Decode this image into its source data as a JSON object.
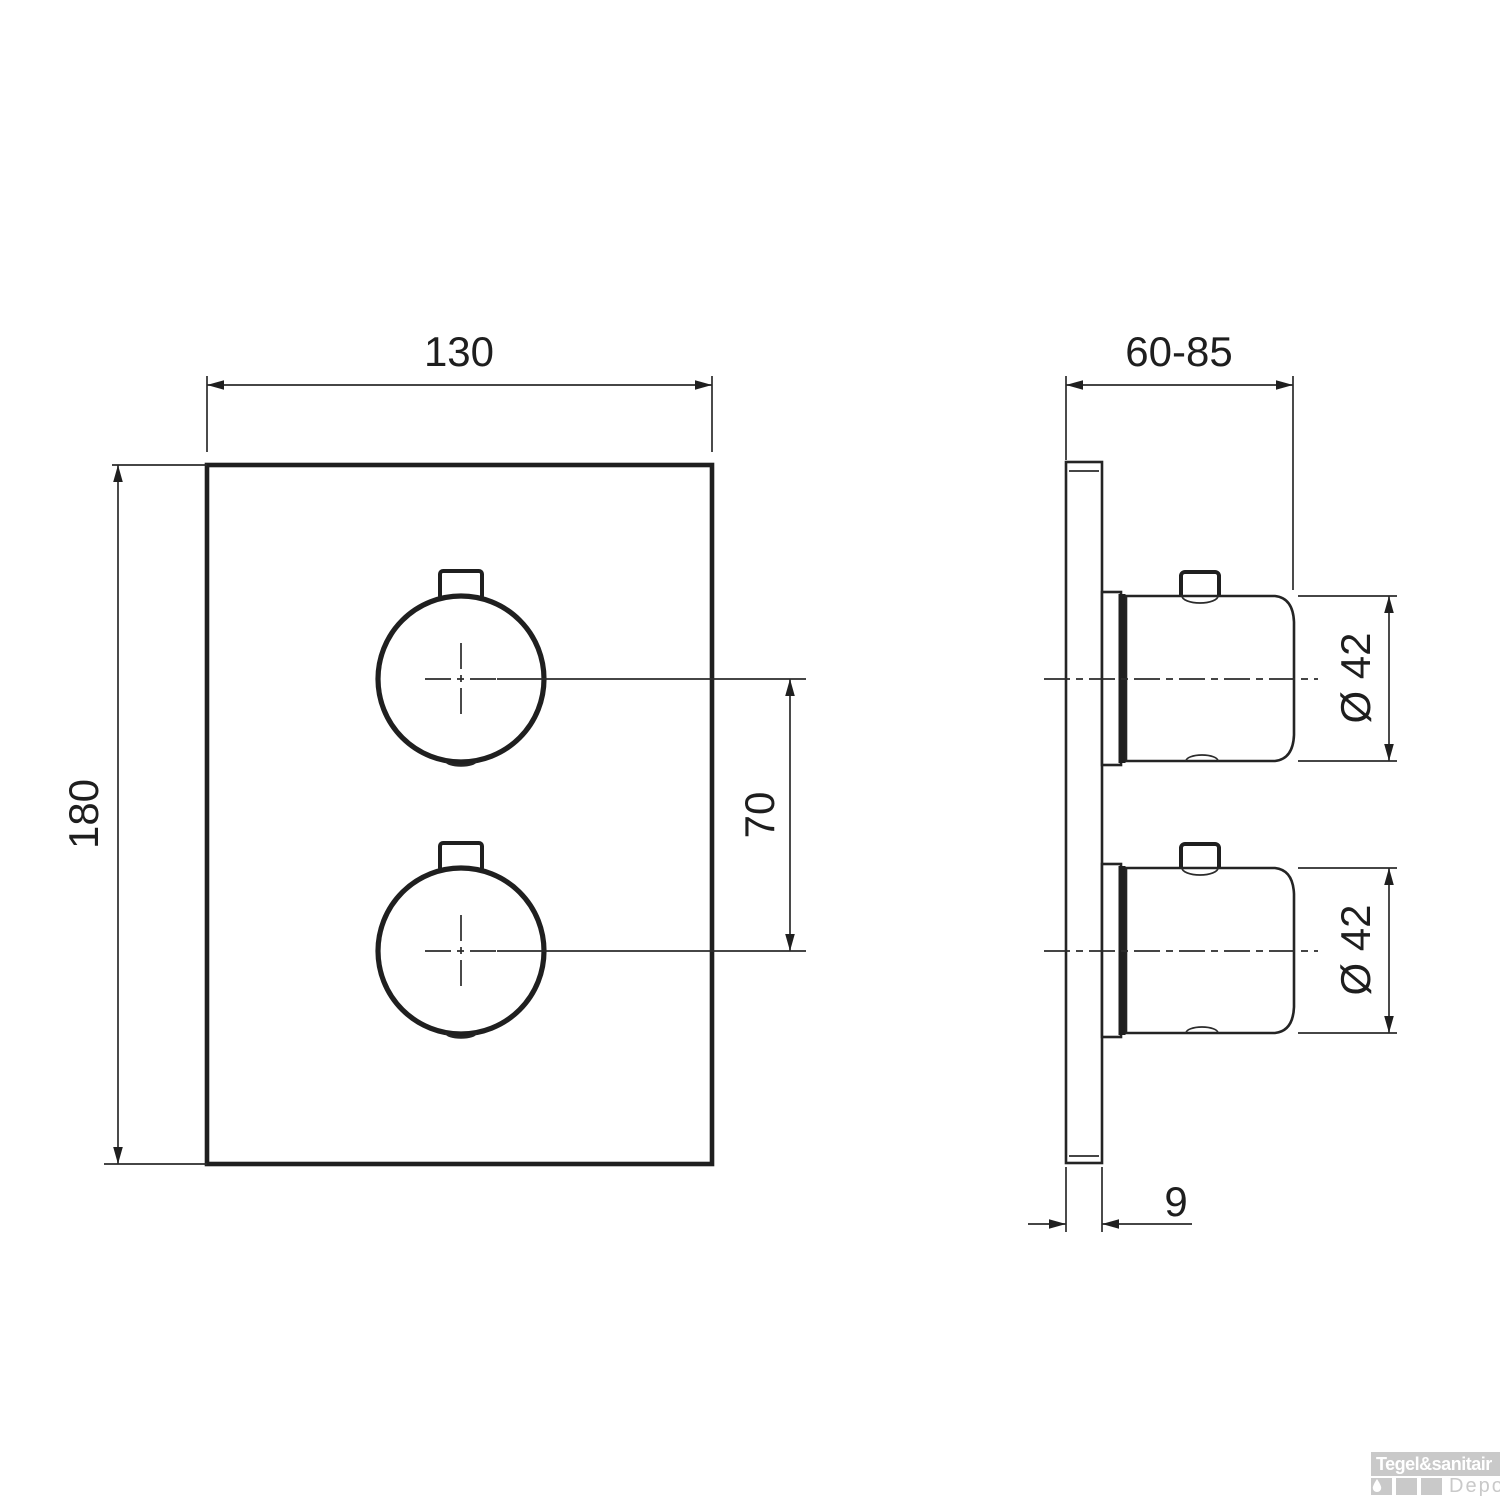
{
  "drawing": {
    "type": "technical-dimension-diagram",
    "front_view": {
      "width": "130",
      "height": "180",
      "handle_spacing": "70"
    },
    "side_view": {
      "depth_range": "60-85",
      "handle_diameter_top": "Ø 42",
      "handle_diameter_bottom": "Ø 42",
      "plate_thickness": "9"
    }
  },
  "watermark": {
    "brand": "Tegel&sanitair",
    "sub_brand": "Depot"
  },
  "colors": {
    "line": "#1f1f1f",
    "watermark_gray": "#c9c9c9",
    "watermark_text": "#ffffff",
    "background": "#ffffff"
  }
}
